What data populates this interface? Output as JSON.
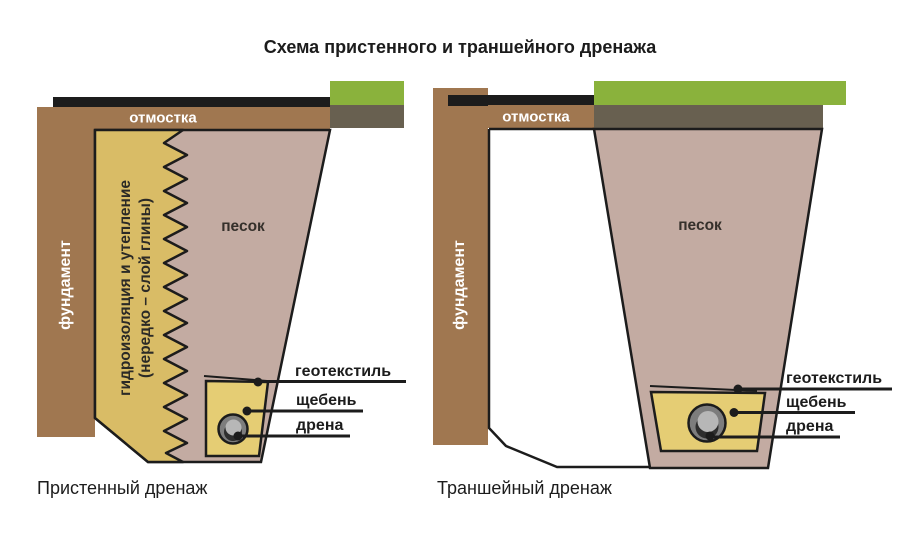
{
  "title": "Схема пристенного и траншейного дренажа",
  "palette": {
    "outline": "#1c1c1c",
    "brown": "#a07750",
    "clay_yellow": "#d9bc66",
    "gravel_yellow": "#e5cd74",
    "sand_pink": "#c3aba2",
    "grass_green": "#8ab23c",
    "soil_olive": "#686050",
    "pipe_ring_gray": "#7d7d7d",
    "pipe_inner_gray": "#b7b7b7",
    "pipe_shadow": "#2e2e2e"
  },
  "left_diagram": {
    "caption": "Пристенный дренаж",
    "labels": {
      "blind_area": "отмостка",
      "foundation": "фундамент",
      "waterproofing_line1": "гидроизоляция и утепление",
      "waterproofing_line2": "(нередко – слой глины)",
      "sand": "песок",
      "geotextile": "геотекстиль",
      "gravel": "щебень",
      "drain": "дрена"
    }
  },
  "right_diagram": {
    "caption": "Траншейный дренаж",
    "labels": {
      "blind_area": "отмостка",
      "foundation": "фундамент",
      "sand": "песок",
      "geotextile": "геотекстиль",
      "gravel": "щебень",
      "drain": "дрена"
    }
  }
}
